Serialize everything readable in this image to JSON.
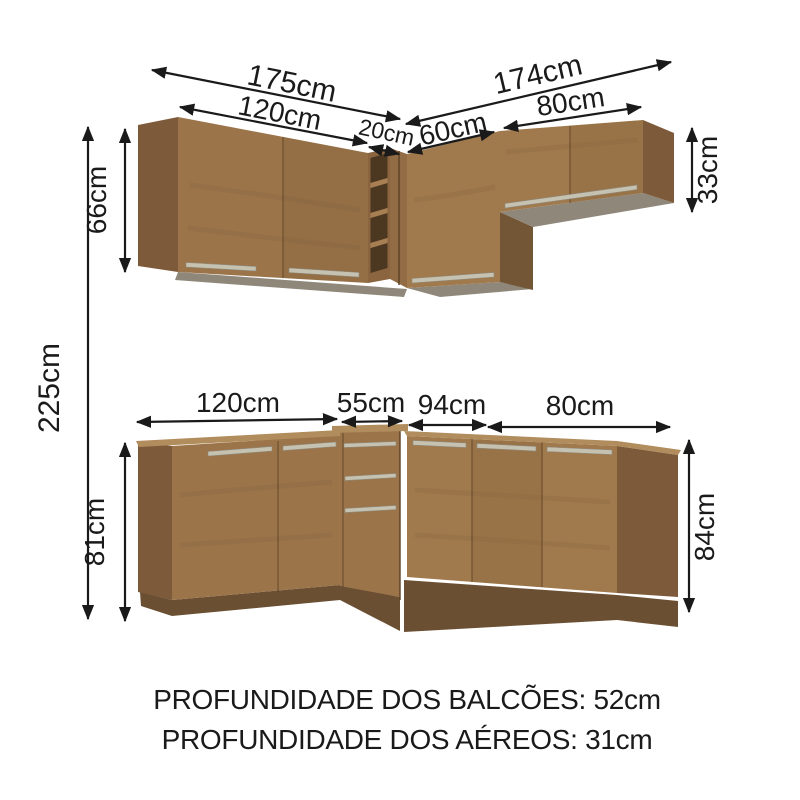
{
  "title": "kitchen cabinet set dimension diagram",
  "dims": {
    "upper_total_left": "175cm",
    "upper_total_right": "174cm",
    "upper_left_width": "120cm",
    "upper_shelf_width": "20cm",
    "upper_corner_width": "60cm",
    "upper_right_width": "80cm",
    "upper_left_height": "66cm",
    "upper_right_height": "33cm",
    "total_height": "225cm",
    "lower_left_width": "120cm",
    "lower_drawer_width": "55cm",
    "lower_corner_width": "94cm",
    "lower_right_width": "80cm",
    "lower_left_height": "81cm",
    "lower_right_height": "84cm"
  },
  "footer": {
    "balcoes_depth": "PROFUNDIDADE DOS BALCÕES: 52cm",
    "aereos_depth": "PROFUNDIDADE DOS AÉREOS: 31cm"
  },
  "colors": {
    "background": "#ffffff",
    "ink": "#1a1a1a",
    "wood_face": "#9b744a",
    "wood_face_light": "#a0794c",
    "wood_side": "#7d5b3a",
    "wood_side_dark": "#735636",
    "counter_top": "#b18c5c",
    "underside_grey": "#8f8779",
    "plinth": "#6b4f33",
    "shelf_frame": "#8a6540",
    "shelf_opening": "#4c3721",
    "shelf_board": "#a87f52",
    "corner_strip": "#916c45",
    "handle": "#c6c2b2",
    "handle_edge": "#8f8b7d",
    "seam": "#5a4024"
  }
}
